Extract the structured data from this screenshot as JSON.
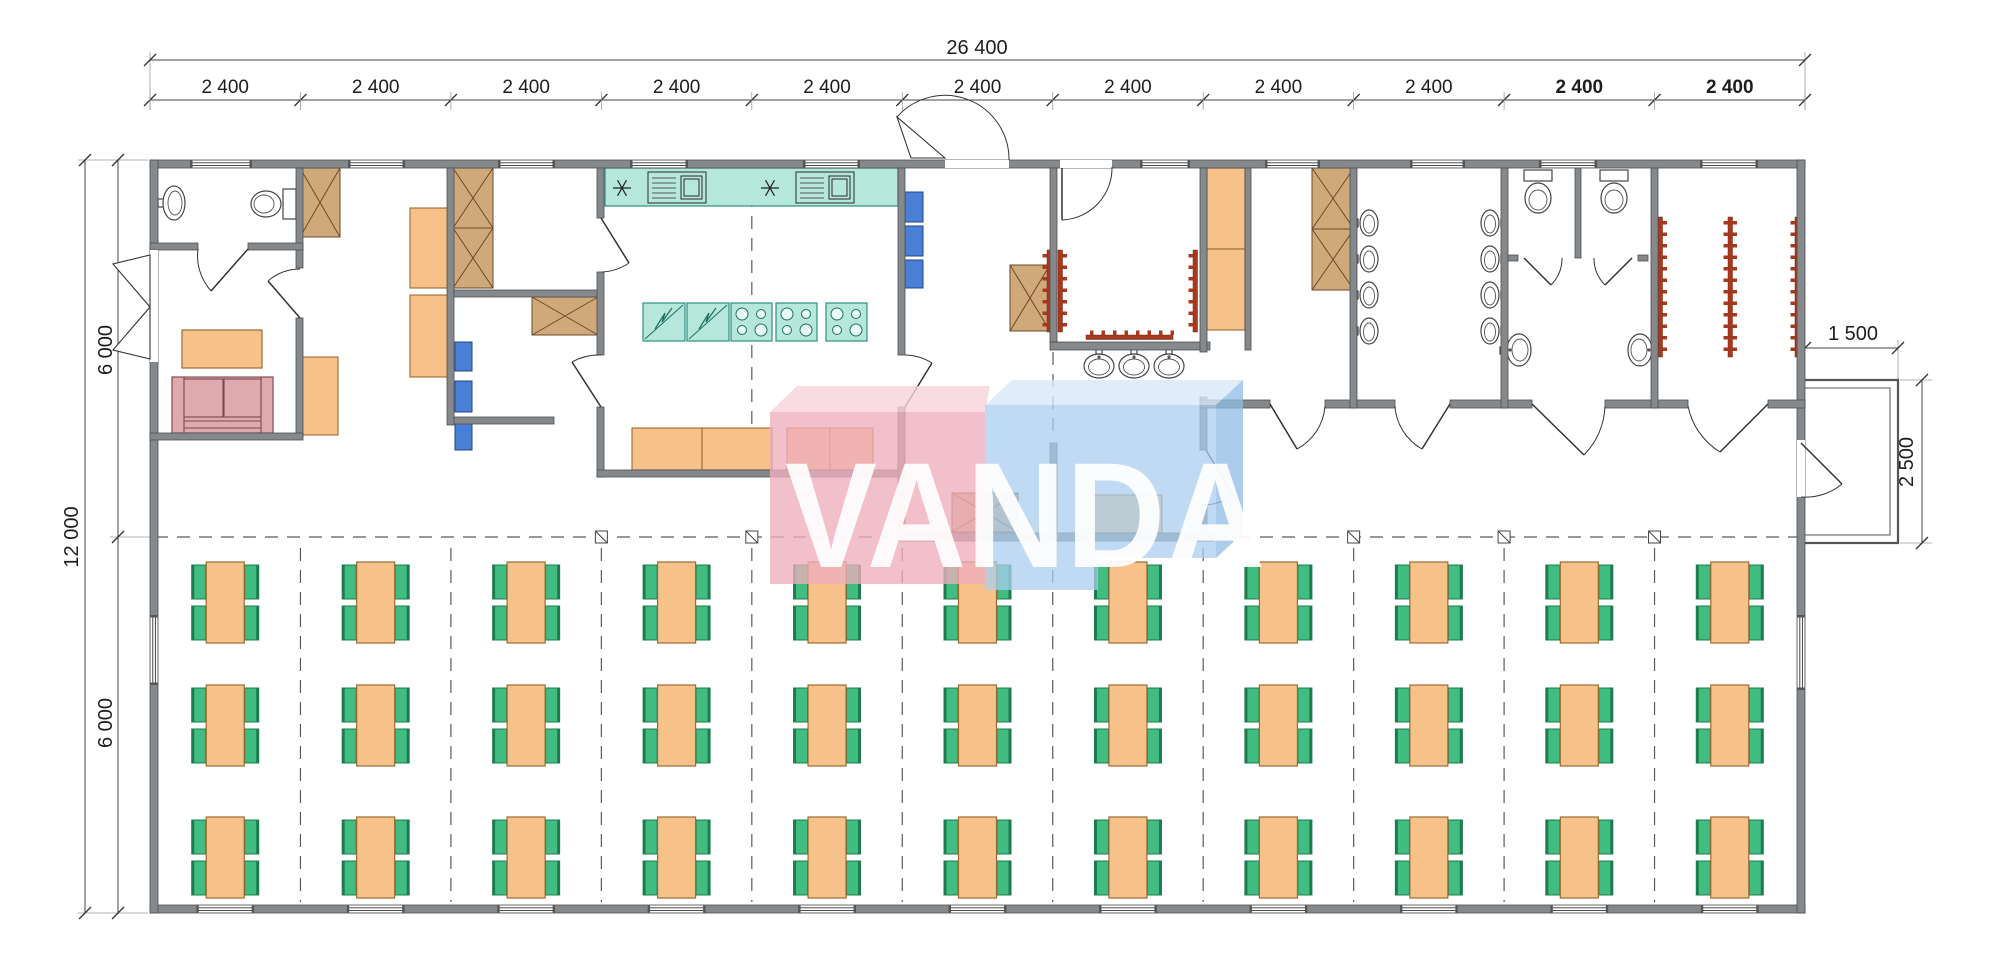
{
  "page": {
    "title": "Modular canteen floor plan"
  },
  "watermark": {
    "text": "VANDA"
  },
  "dimensions": {
    "total_width_label": "26 400",
    "module_width_label": "2 400",
    "module_count": 11,
    "total_height_label": "12 000",
    "half_height_labels": [
      "6 000",
      "6 000"
    ],
    "porch_width_label": "1 500",
    "porch_depth_label": "2 500"
  },
  "dining": {
    "rows": 3,
    "columns": 11,
    "seats_per_table": 4
  },
  "fixtures": {
    "urinals_per_wall": 4,
    "washroom_sinks": 3,
    "toilet_stalls": 2,
    "wc_toilets": 3,
    "coat_racks": 7,
    "kitchen_stoves": 3,
    "kitchen_fridges": 2,
    "kitchen_sink_units": 2
  },
  "colors": {
    "wall": "#85898c",
    "wall_edge": "#4b4f52",
    "table": "#f6c289",
    "table_edge": "#9a6b32",
    "chair": "#41bd81",
    "chair_edge": "#1d7c4d",
    "counter": "#b5e7da",
    "counter_edge": "#2e8f80",
    "cabinet": "#cfa97a",
    "cabinet_edge": "#6b4a2a",
    "shelf_blue": "#4a7fd6",
    "shelf_blue_edge": "#24468a",
    "sofa": "#dfa9ad",
    "coat_rack": "#a8391c",
    "watermark_pink": "#eeaebd",
    "watermark_pink_top": "#f6d3da",
    "watermark_blue": "#a9cdee",
    "watermark_blue_top": "#d8e9f8",
    "watermark_blue_side": "#8fbce4",
    "dim_text": "#1d1d1d"
  }
}
